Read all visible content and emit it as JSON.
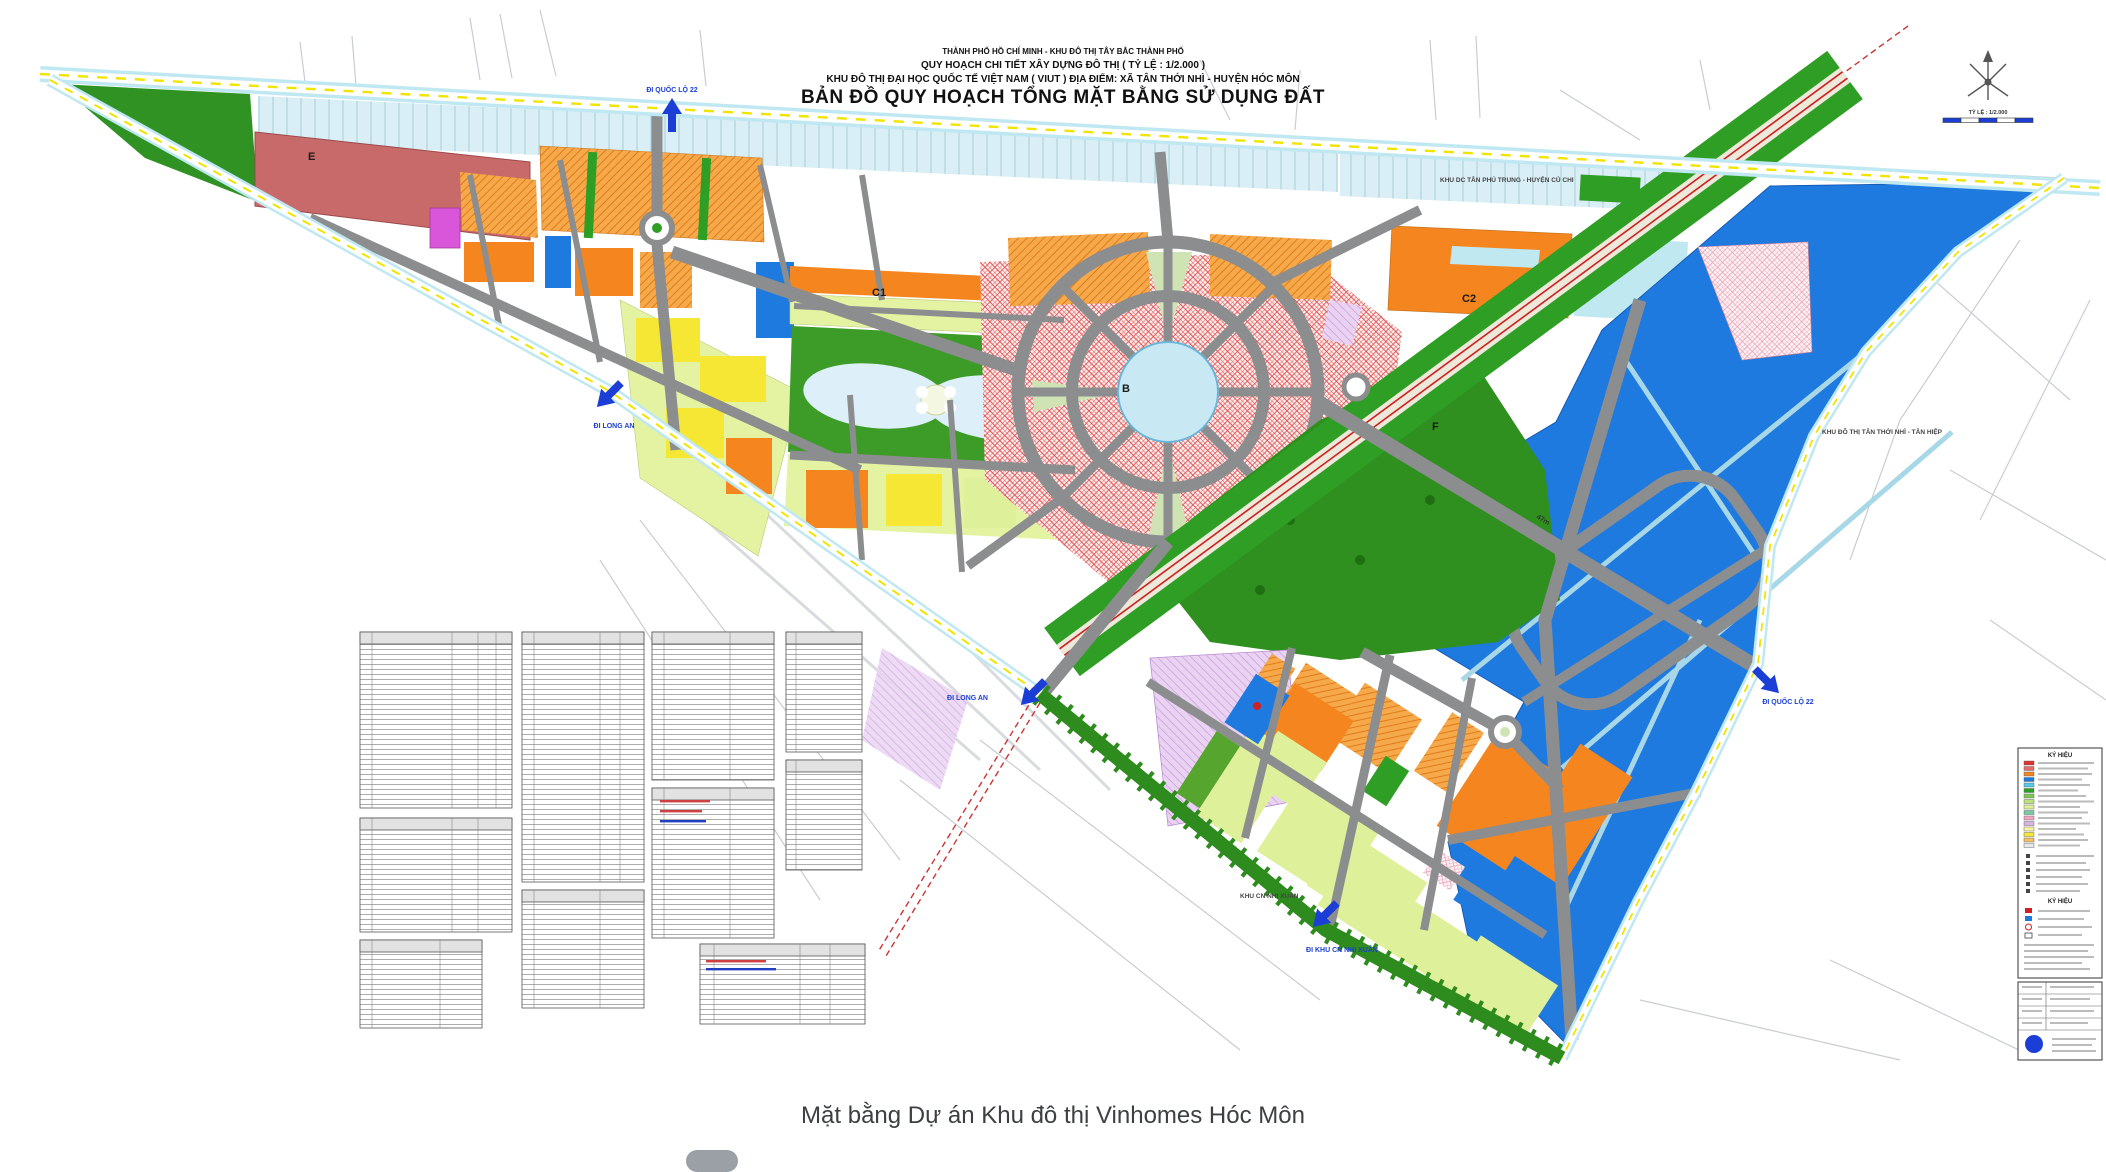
{
  "page": {
    "caption": "Mặt bằng Dự án Khu đô thị Vinhomes Hóc Môn"
  },
  "map": {
    "header": {
      "line1": "THÀNH PHỐ HỒ CHÍ MINH - KHU ĐÔ THỊ TÂY BẮC THÀNH PHỐ",
      "line2": "QUY HOẠCH CHI TIẾT XÂY DỰNG ĐÔ THỊ ( TỶ LỆ : 1/2.000 )",
      "line3": "KHU ĐÔ THỊ ĐẠI HỌC QUỐC TẾ VIỆT NAM ( VIUT ) ĐỊA ĐIỂM: XÃ TÂN THỚI NHÌ - HUYỆN HÓC MÔN",
      "line4": "BẢN ĐỒ QUY HOẠCH TỔNG MẶT BẰNG SỬ DỤNG ĐẤT"
    },
    "north_scale": {
      "scale_label": "TỶ LỆ : 1/2.000"
    },
    "zones": {
      "e": "E",
      "c1": "C1",
      "b": "B",
      "c2": "C2",
      "f": "F"
    },
    "roads": {
      "width_label": "47m"
    },
    "arrows": {
      "top": "ĐI QUỐC LỘ 22",
      "west": "ĐI LONG AN",
      "south_center": "ĐI LONG AN",
      "east": "ĐI QUỐC LỘ 22",
      "south": "ĐI KHU CN NHỊ XUÂN"
    },
    "peripheral": {
      "top_right": "KHU DC TÂN PHÚ TRUNG - HUYỆN CỦ CHI",
      "east": "KHU ĐÔ THỊ TÂN THỚI NHÌ - TÂN HIỆP",
      "bottom": "KHU CN NHỊ XUÂN"
    },
    "legend": {
      "header": "KÝ HIỆU",
      "header2": "KÝ HIỆU",
      "swatches": [
        "#e03131",
        "#e46a6a",
        "#f5861f",
        "#1f7ae0",
        "#56c8e8",
        "#2f9e25",
        "#7fc855",
        "#b9e27e",
        "#dff09a",
        "#79caa2",
        "#f2a7c3",
        "#d9b3e6",
        "#f9f3a6",
        "#f5e733",
        "#f3c163",
        "#e8e8e8"
      ]
    },
    "colors": {
      "residential_orange": "#f5861f",
      "mixed_center_red_hatch": "#e05555",
      "education_blue": "#1f7ae0",
      "park_green": "#2f9e25",
      "low_rise_yellow_green": "#dff09a",
      "yellow": "#f5e733",
      "water_cyan": "#bfe6f2",
      "road_gray": "#8b8d8f"
    }
  }
}
